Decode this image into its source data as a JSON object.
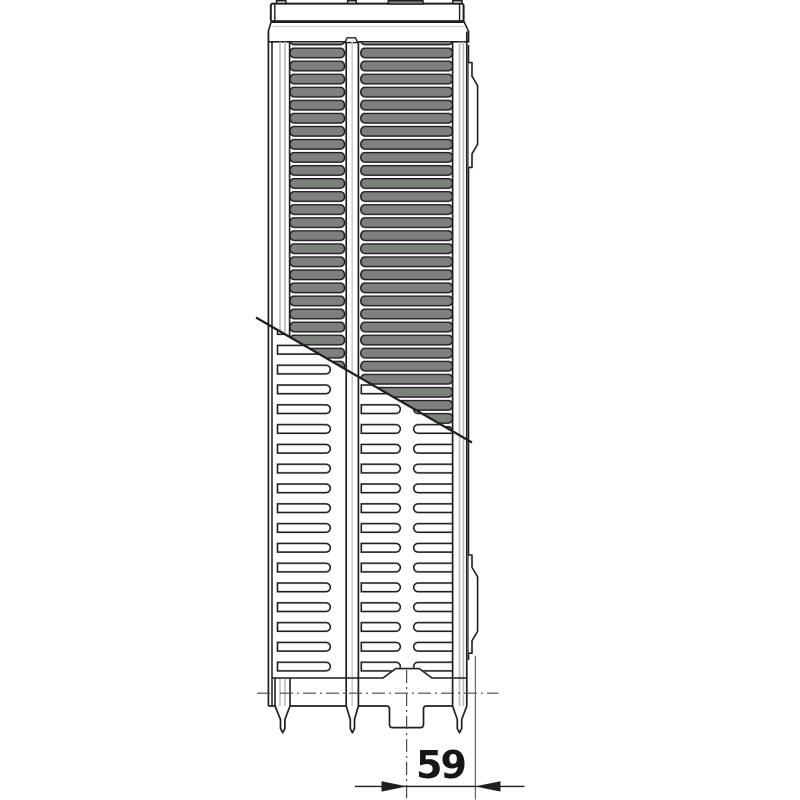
{
  "drawing": {
    "name": "radiator-side-profile-technical-drawing",
    "dimension": {
      "label": "59"
    }
  },
  "colors": {
    "line": "#1f1f1f",
    "slot_fill": "#7c817b",
    "shade_line": "#b7bab7",
    "centerline": "#4a4a4a",
    "extension_line": "#666666",
    "label_color": "#161616"
  }
}
